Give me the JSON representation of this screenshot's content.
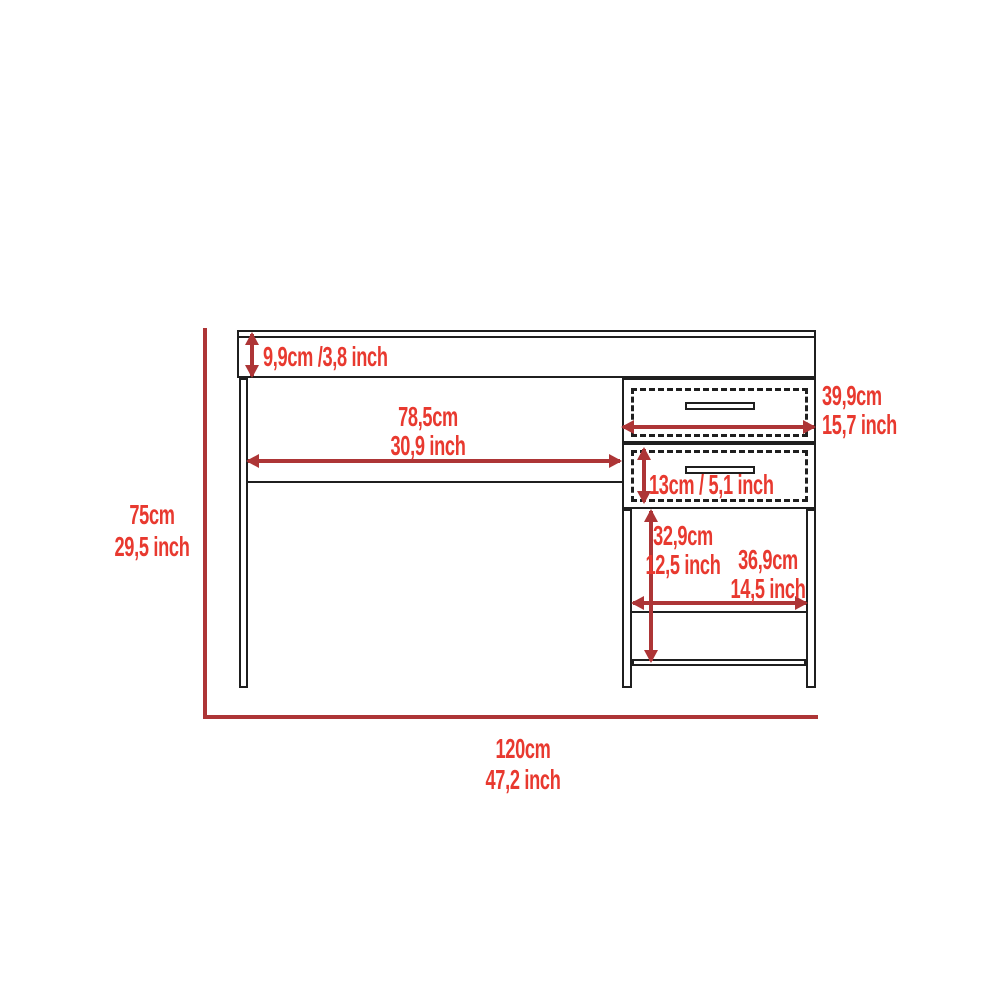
{
  "diagram_title": "desk-dimension-diagram",
  "colors": {
    "outline": "#1f1f1f",
    "dimension_line": "#ad3536",
    "dimension_text": "#e8392f",
    "background": "#ffffff"
  },
  "dimensions": {
    "desktop_thickness": {
      "label": "9,9cm /3,8 inch"
    },
    "knee_space_width": {
      "cm": "78,5cm",
      "inch": "30,9 inch"
    },
    "drawer_width": {
      "cm": "39,9cm",
      "inch": "15,7 inch"
    },
    "drawer_height": {
      "label": "13cm / 5,1 inch"
    },
    "cabinet_opening_height": {
      "cm": "32,9cm",
      "inch": "12,5 inch"
    },
    "shelf_width": {
      "cm": "36,9cm",
      "inch": "14,5 inch"
    },
    "overall_height": {
      "cm": "75cm",
      "inch": "29,5 inch"
    },
    "overall_width": {
      "cm": "120cm",
      "inch": "47,2 inch"
    }
  }
}
